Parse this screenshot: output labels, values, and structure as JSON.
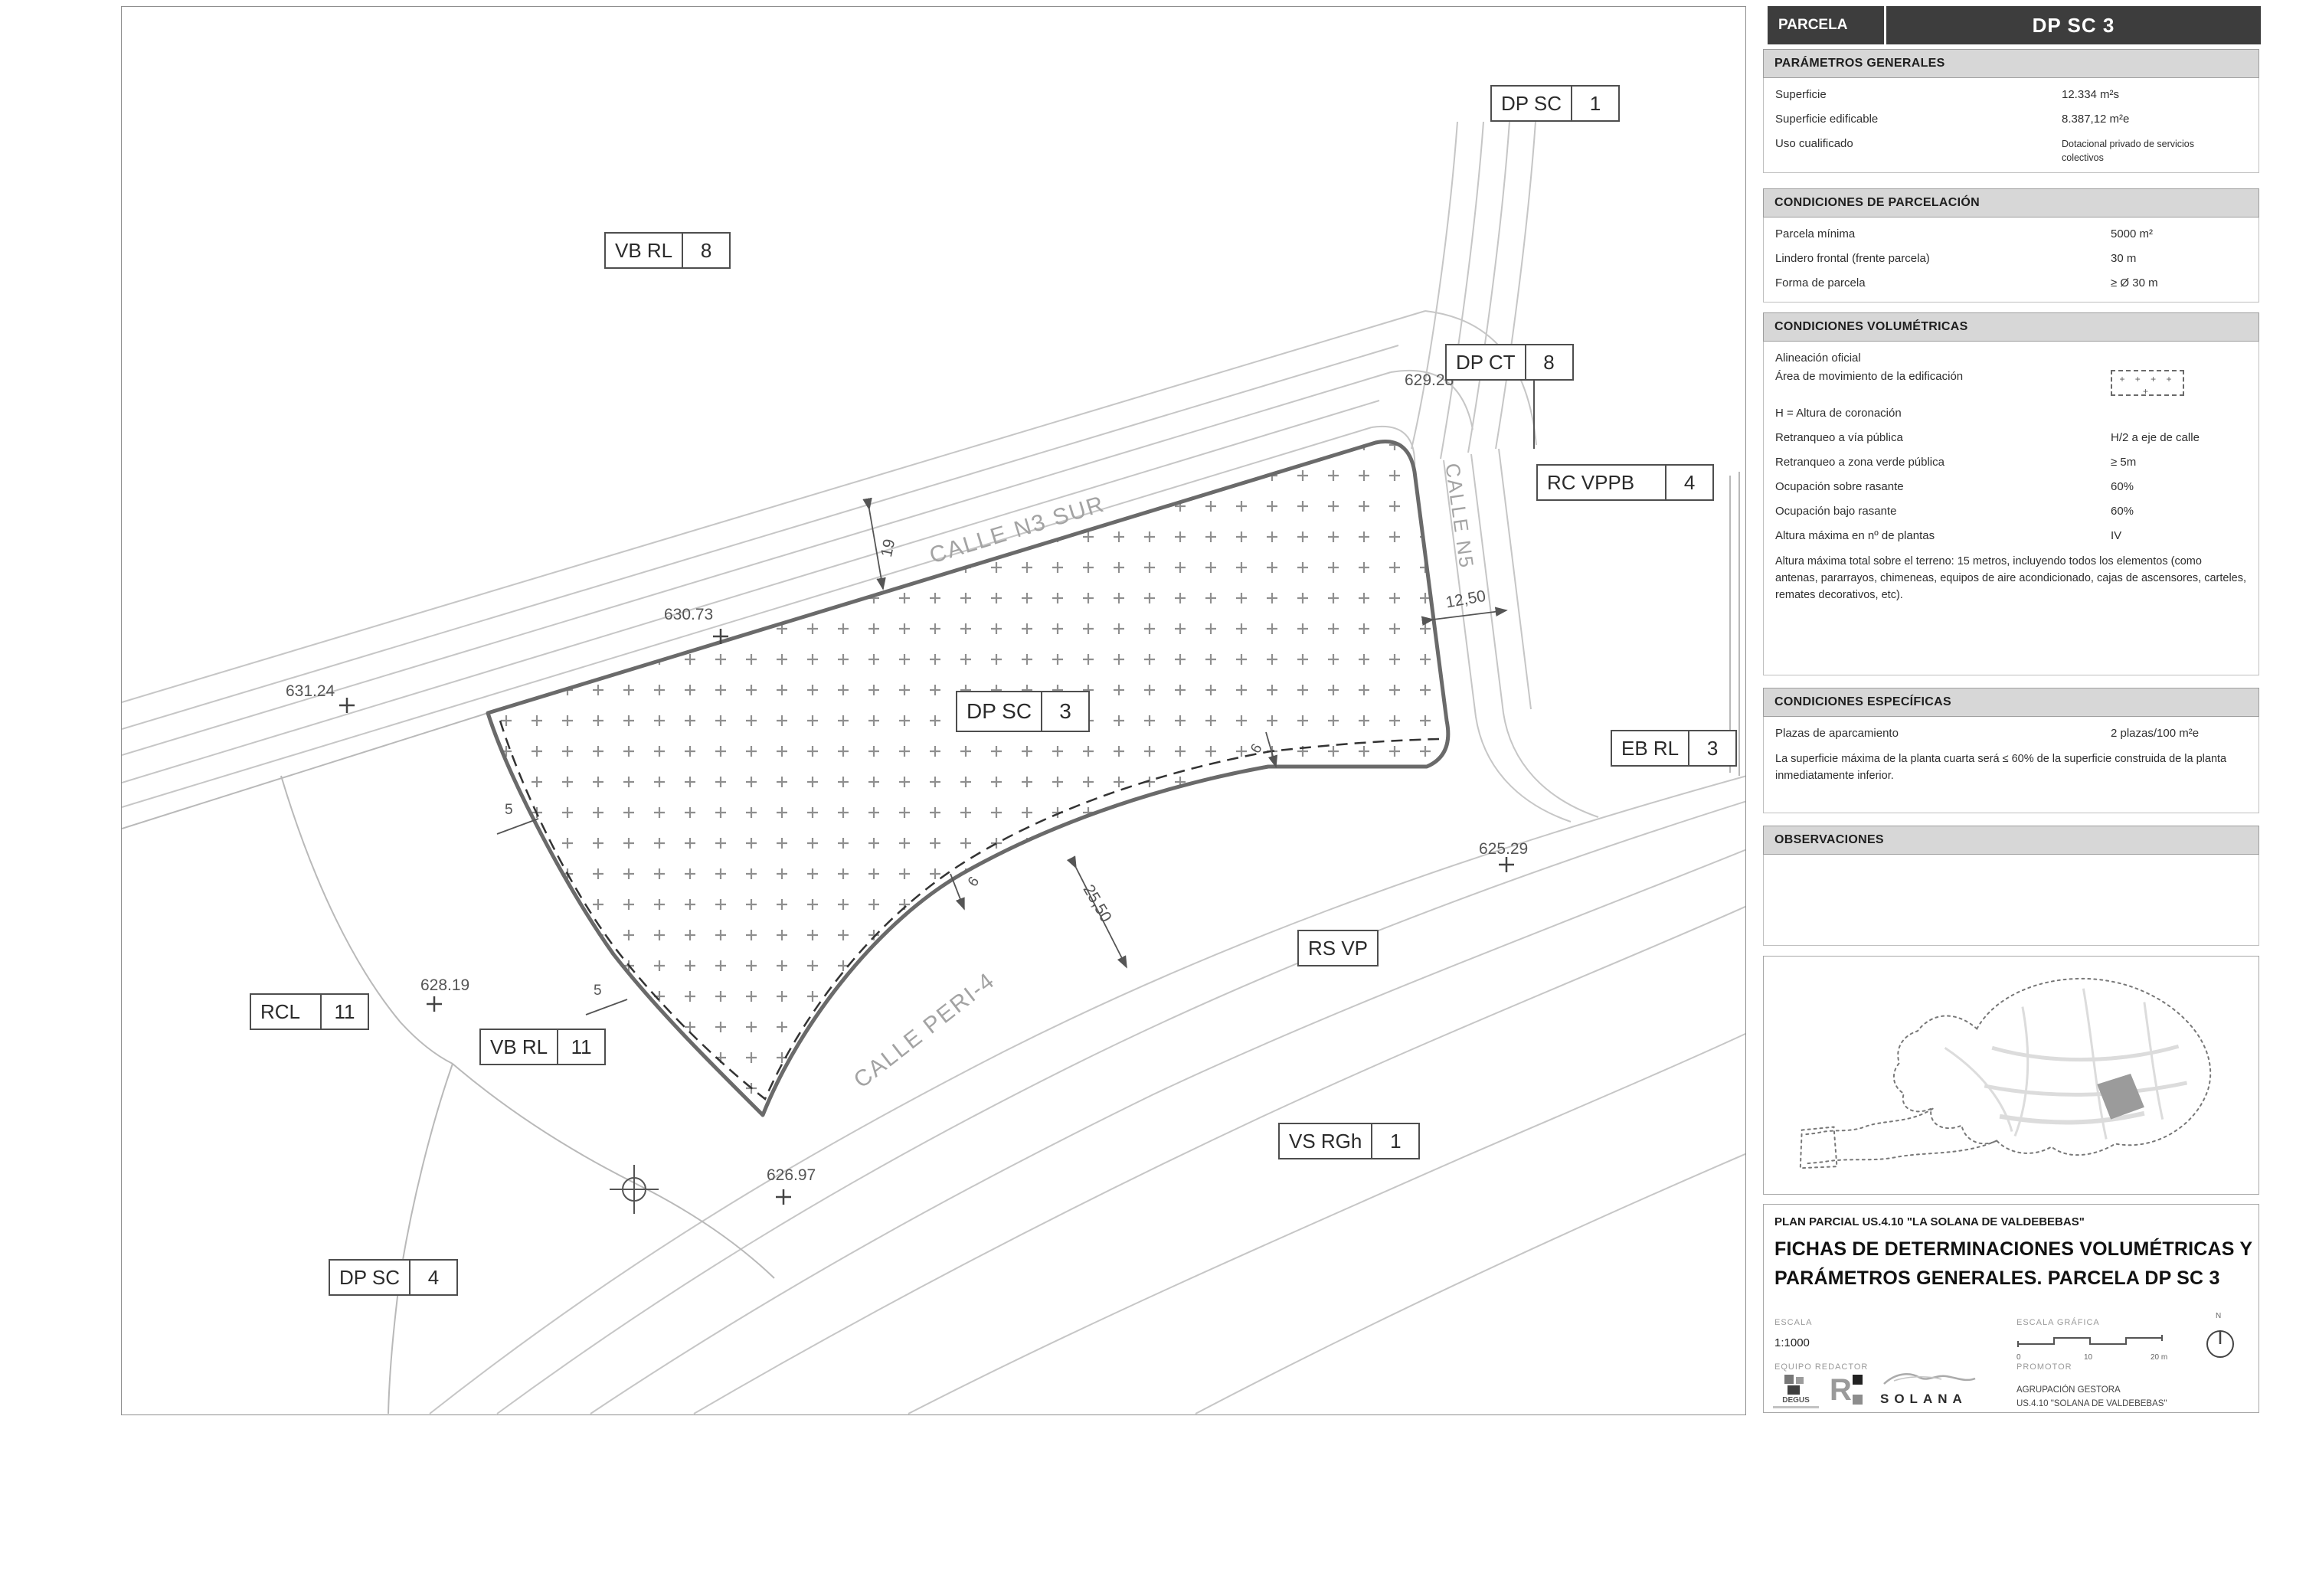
{
  "header": {
    "label": "PARCELA",
    "value": "DP SC 3"
  },
  "parametros": {
    "title": "PARÁMETROS GENERALES",
    "rows": [
      {
        "label": "Superficie",
        "value": "12.334 m²s"
      },
      {
        "label": "Superficie edificable",
        "value": "8.387,12 m²e"
      },
      {
        "label": "Uso cualificado",
        "value": "Dotacional privado de servicios colectivos"
      }
    ]
  },
  "parcelacion": {
    "title": "CONDICIONES DE PARCELACIÓN",
    "rows": [
      {
        "label": "Parcela mínima",
        "value": "5000 m²"
      },
      {
        "label": "Lindero frontal (frente parcela)",
        "value": "30 m"
      },
      {
        "label": "Forma de parcela",
        "value": "≥ Ø 30 m"
      }
    ]
  },
  "volumetricas": {
    "title": "CONDICIONES VOLUMÉTRICAS",
    "legend_plus": "+ + + + +",
    "rows": [
      {
        "label": "Alineación oficial",
        "value": ""
      },
      {
        "label": "Área de movimiento de la edificación",
        "value": ""
      },
      {
        "label": "H = Altura de coronación",
        "value": ""
      },
      {
        "label": "Retranqueo a vía pública",
        "value": "H/2 a eje de calle"
      },
      {
        "label": "Retranqueo a zona verde pública",
        "value": "≥ 5m"
      },
      {
        "label": "Ocupación sobre rasante",
        "value": "60%"
      },
      {
        "label": "Ocupación bajo rasante",
        "value": "60%"
      },
      {
        "label": "Altura máxima en nº de plantas",
        "value": "IV"
      }
    ],
    "note": "Altura máxima total sobre el terreno: 15 metros, incluyendo todos los elementos (como antenas, pararrayos, chimeneas, equipos de aire acondicionado, cajas de ascensores, carteles, remates decorativos, etc)."
  },
  "especificas": {
    "title": "CONDICIONES ESPECÍFICAS",
    "rows": [
      {
        "label": "Plazas de aparcamiento",
        "value": "2 plazas/100 m²e"
      }
    ],
    "note": "La superficie máxima de la planta cuarta será ≤ 60% de la superficie construida de la planta inmediatamente inferior."
  },
  "observaciones": {
    "title": "OBSERVACIONES"
  },
  "map": {
    "streets": {
      "n3sur": "CALLE N3 SUR",
      "n5": "CALLE N5",
      "peri4": "CALLE PERI-4"
    },
    "boxes": [
      {
        "code": "DP SC",
        "num": "1"
      },
      {
        "code": "VB RL",
        "num": "8"
      },
      {
        "code": "DP CT",
        "num": "8"
      },
      {
        "code": "RC VPPB",
        "num": "4"
      },
      {
        "code": "EB RL",
        "num": "3"
      },
      {
        "code": "DP SC",
        "num": "3"
      },
      {
        "code": "RS VP"
      },
      {
        "code": "VS RGh",
        "num": "1"
      },
      {
        "code": "RCL",
        "num": "11"
      },
      {
        "code": "VB RL",
        "num": "11"
      },
      {
        "code": "DP SC",
        "num": "4"
      }
    ],
    "elevations": [
      "629.28",
      "630.73",
      "631.24",
      "628.19",
      "626.97",
      "625.29"
    ],
    "dims": [
      "19",
      "12,50",
      "25,50",
      "5",
      "5",
      "6",
      "6"
    ]
  },
  "titleblock": {
    "plan": "PLAN PARCIAL US.4.10 \"LA SOLANA DE VALDEBEBAS\"",
    "title_line1": "FICHAS DE DETERMINACIONES VOLUMÉTRICAS Y",
    "title_line2": "PARÁMETROS GENERALES. PARCELA DP SC 3",
    "escala_label": "ESCALA",
    "escala_value": "1:1000",
    "grafica_label": "ESCALA GRÁFICA",
    "ticks": [
      "0",
      "10",
      "20 m"
    ],
    "north": "N",
    "equipo_label": "EQUIPO REDACTOR",
    "promotor_label": "PROMOTOR",
    "degus": "DEGUS",
    "solana": "SOLANA",
    "promotor_line1": "AGRUPACIÓN GESTORA",
    "promotor_line2": "US.4.10 \"SOLANA DE VALDEBEBAS\""
  }
}
